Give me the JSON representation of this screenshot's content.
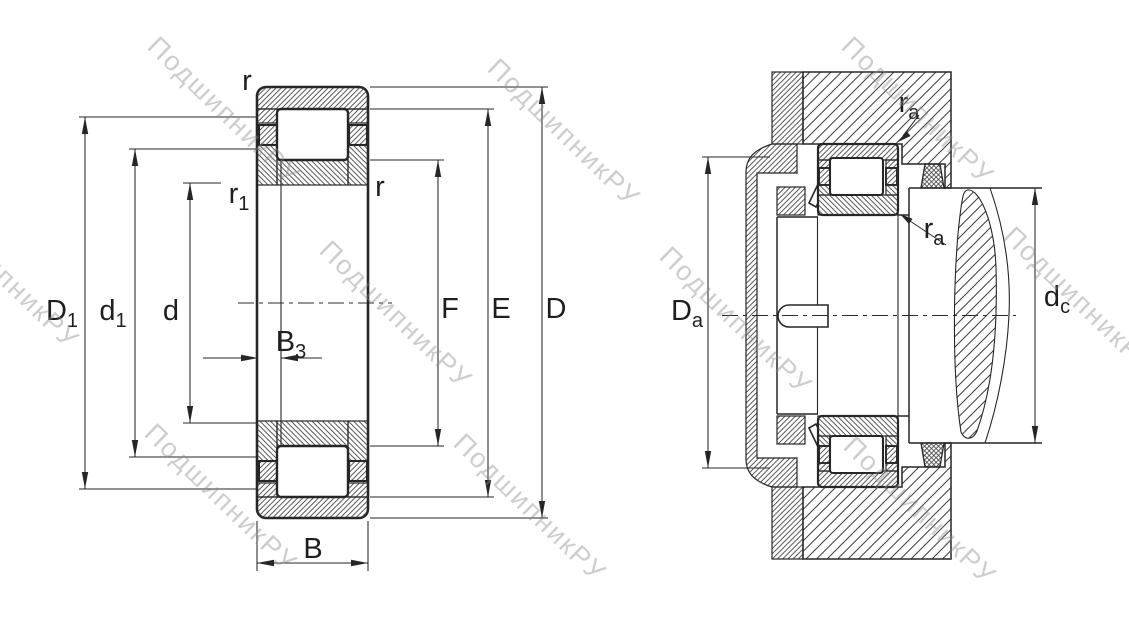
{
  "title": "Cylindrical roller bearing dimension drawing",
  "colors": {
    "line": "#262626",
    "hatch": "#3f3f3f",
    "watermark": "#8a8a8a",
    "background": "#ffffff"
  },
  "watermark": {
    "text": "ПодшипникРУ"
  },
  "left_view": {
    "name": "bearing-cross-section",
    "labels": {
      "r_top": {
        "main": "r",
        "sub": ""
      },
      "r1": {
        "main": "r",
        "sub": "1"
      },
      "r_right": {
        "main": "r",
        "sub": ""
      },
      "D1": {
        "main": "D",
        "sub": "1"
      },
      "d1": {
        "main": "d",
        "sub": "1"
      },
      "d": {
        "main": "d",
        "sub": ""
      },
      "B3": {
        "main": "B",
        "sub": "3"
      },
      "B": {
        "main": "B",
        "sub": ""
      },
      "F": {
        "main": "F",
        "sub": ""
      },
      "E": {
        "main": "E",
        "sub": ""
      },
      "D": {
        "main": "D",
        "sub": ""
      }
    }
  },
  "right_view": {
    "name": "mounted-bearing-section",
    "labels": {
      "ra_top": {
        "main": "r",
        "sub": "a"
      },
      "ra_bottom": {
        "main": "r",
        "sub": "a"
      },
      "Da": {
        "main": "D",
        "sub": "a"
      },
      "dc": {
        "main": "d",
        "sub": "c"
      }
    }
  }
}
